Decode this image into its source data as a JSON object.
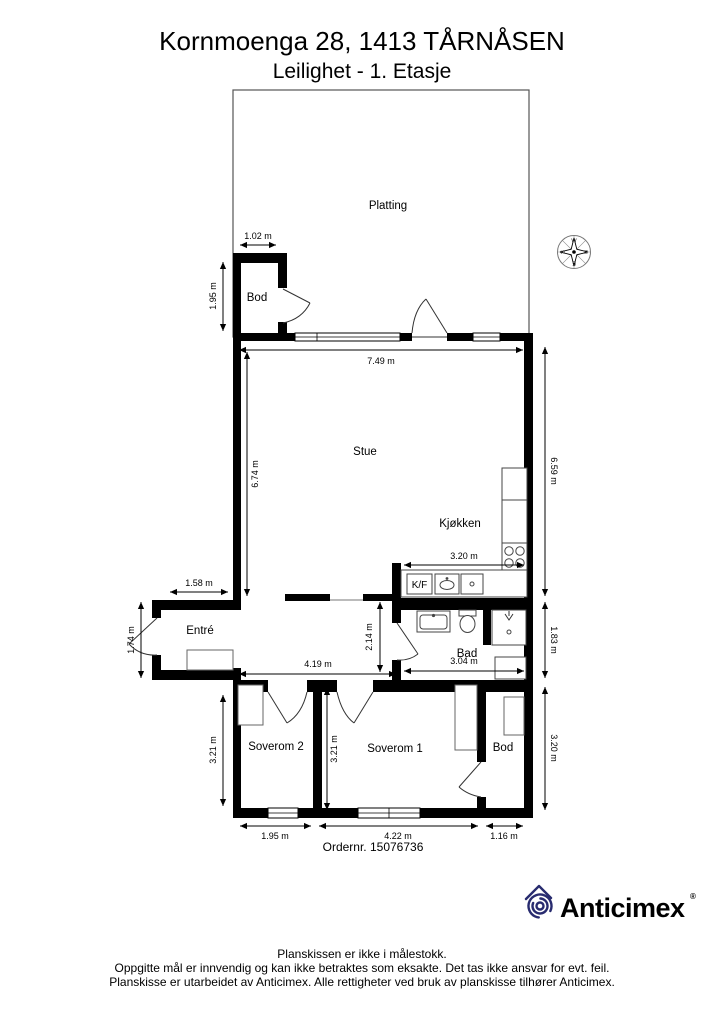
{
  "title": "Kornmoenga 28, 1413 TÅRNÅSEN",
  "subtitle": "Leilighet  - 1. Etasje",
  "rooms": {
    "platting": "Platting",
    "bod_top": "Bod",
    "stue": "Stue",
    "kjokken": "Kjøkken",
    "entre": "Entré",
    "bad": "Bad",
    "soverom2": "Soverom 2",
    "soverom1": "Soverom 1",
    "bod_bottom": "Bod",
    "fridge": "K/F"
  },
  "dims": {
    "bod_w": "1.02 m",
    "bod_h": "1.95 m",
    "stue_w": "7.49 m",
    "stue_h_left": "6.74 m",
    "stue_h_right": "6.59 m",
    "entre_w": "1.58 m",
    "entre_h": "1.74 m",
    "kitchen_w": "3.20 m",
    "hall_w": "4.19 m",
    "hall_h": "2.14 m",
    "bad_w": "3.04 m",
    "bad_h": "1.83 m",
    "sov2_h": "3.21 m",
    "sov1_h": "3.21 m",
    "bod2_h": "3.20 m",
    "sov2_w": "1.95 m",
    "sov1_w": "4.22 m",
    "bod2_w": "1.16 m"
  },
  "compass": {
    "n": "N",
    "e": "E",
    "s": "S",
    "w": "W"
  },
  "order": "Ordernr. 15076736",
  "logo": {
    "brand": "Anticimex",
    "reg": "®",
    "color": "#282b6f"
  },
  "footer": {
    "line1": "Planskissen er ikke i målestokk.",
    "line2": "Oppgitte mål er innvendig og kan ikke betraktes som eksakte. Det tas ikke ansvar for evt. feil.",
    "line3": "Planskisse er utarbeidet av Anticimex. Alle rettigheter ved bruk av planskisse tilhører Anticimex."
  }
}
